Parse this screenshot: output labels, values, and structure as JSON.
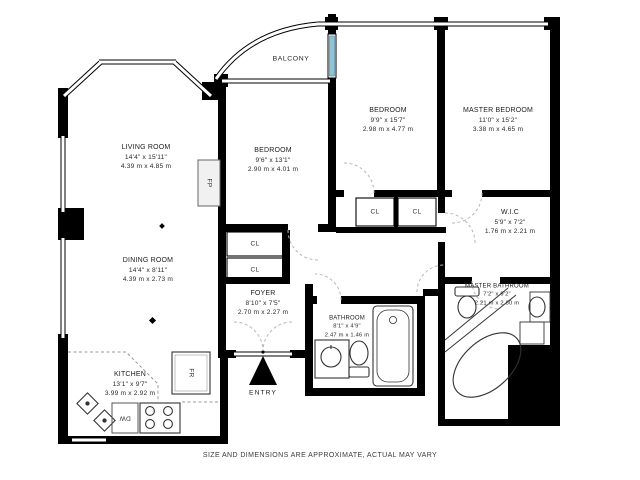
{
  "disclaimer": "SIZE AND DIMENSIONS ARE APPROXIMATE, ACTUAL MAY VARY",
  "rooms": {
    "balcony": {
      "name": "BALCONY"
    },
    "living_room": {
      "name": "LIVING ROOM",
      "imperial": "14'4\" x 15'11\"",
      "metric": "4.39 m x 4.85 m"
    },
    "bedroom_center": {
      "name": "BEDROOM",
      "imperial": "9'6\" x 13'1\"",
      "metric": "2.90 m x 4.01 m"
    },
    "bedroom_second": {
      "name": "BEDROOM",
      "imperial": "9'9\" x 15'7\"",
      "metric": "2.98 m x 4.77 m"
    },
    "master_bedroom": {
      "name": "MASTER BEDROOM",
      "imperial": "11'0\" x 15'2\"",
      "metric": "3.38 m x 4.65 m"
    },
    "dining_room": {
      "name": "DINING ROOM",
      "imperial": "14'4\" x 8'11\"",
      "metric": "4.39 m x 2.73 m"
    },
    "kitchen": {
      "name": "KITCHEN",
      "imperial": "13'1\" x 9'7\"",
      "metric": "3.99 m x 2.92 m"
    },
    "foyer": {
      "name": "FOYER",
      "imperial": "8'10\" x 7'5\"",
      "metric": "2.70 m x 2.27 m"
    },
    "bathroom": {
      "name": "BATHROOM",
      "imperial": "8'1\" x 4'9\"",
      "metric": "2.47 m x 1.46 m"
    },
    "master_bathroom": {
      "name": "MASTER BATHROOM",
      "imperial": "7'2\" x 9'2\"",
      "metric": "2.21 m x 2.80 m"
    },
    "wic": {
      "name": "W.I.C",
      "imperial": "5'9\" x 7'2\"",
      "metric": "1.76 m x 2.21 m"
    }
  },
  "markers": {
    "entry": "ENTRY",
    "closet": "CL",
    "fireplace": "FP",
    "fridge": "FR",
    "dishwasher": "DW"
  },
  "colors": {
    "walls": "#000000",
    "background": "#ffffff",
    "door_arc": "#b8b8b8",
    "glass_door": "#8fc3d6",
    "fixtures": "#444444"
  }
}
